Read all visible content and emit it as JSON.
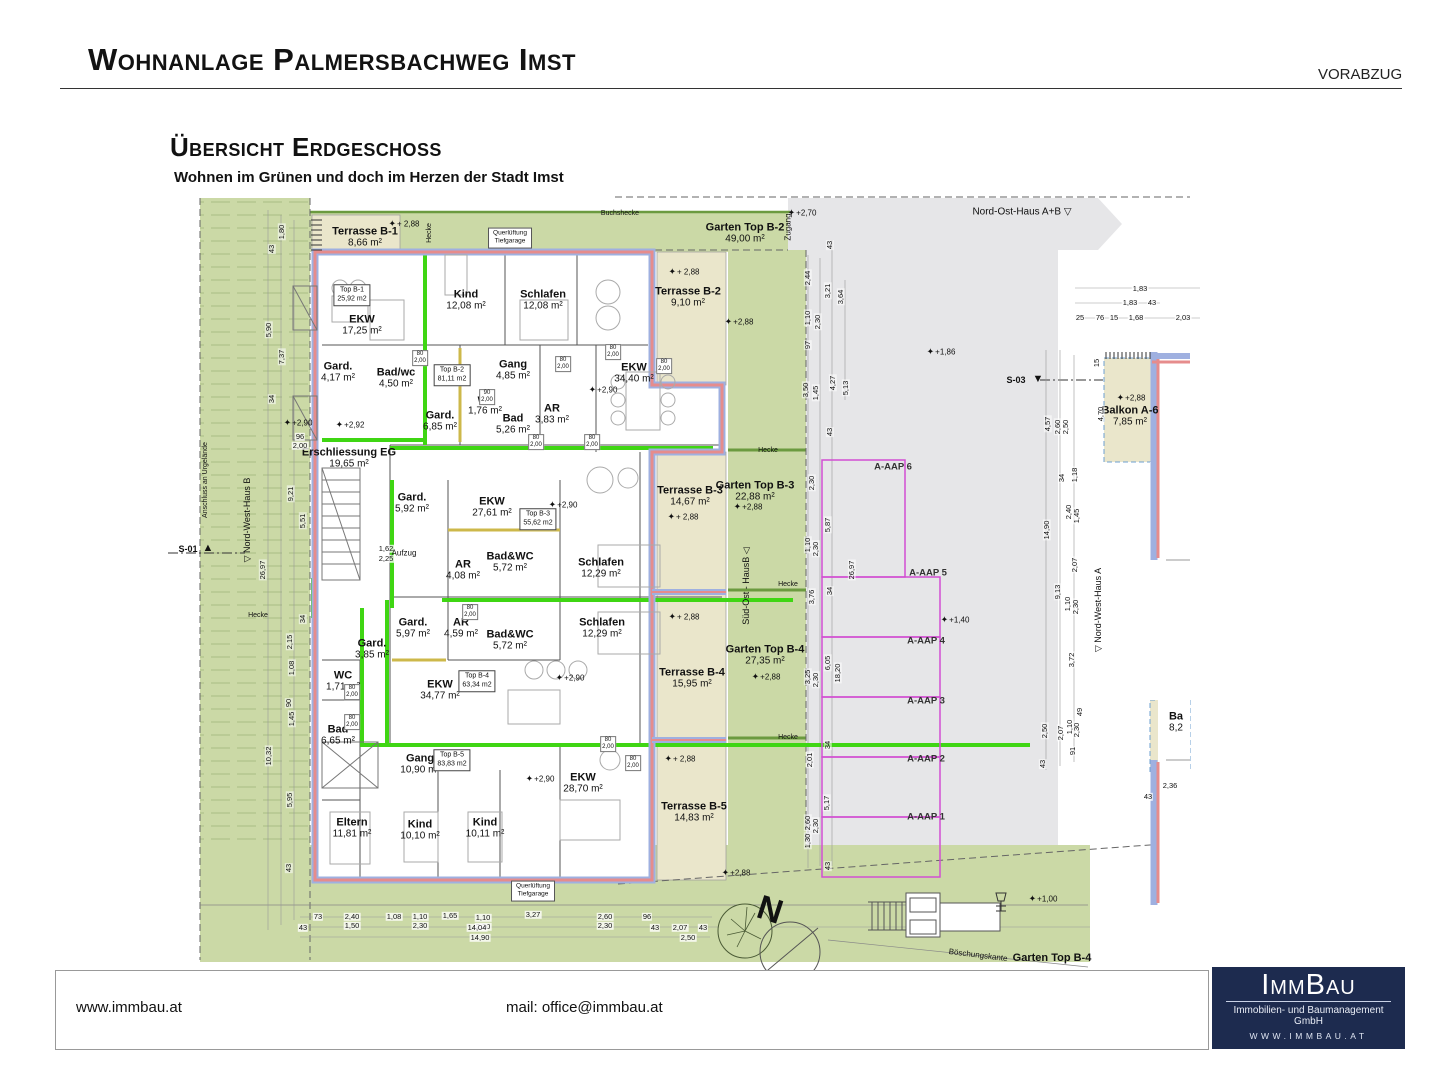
{
  "header": {
    "title": "Wohnanlage Palmersbachweg Imst",
    "stamp": "VORABZUG"
  },
  "section": {
    "title": "Übersicht Erdgeschoss",
    "subtitle": "Wohnen im Grünen und doch im Herzen der Stadt Imst"
  },
  "plan": {
    "rooms": [
      [
        "EKW",
        "17,25 m²",
        362,
        325
      ],
      [
        "Kind",
        "12,08 m²",
        466,
        300
      ],
      [
        "Schlafen",
        "12,08 m²",
        543,
        300
      ],
      [
        "EKW",
        "34,40 m²",
        634,
        373
      ],
      [
        "Gard.",
        "4,17 m²",
        338,
        372
      ],
      [
        "Bad/wc",
        "4,50 m²",
        396,
        378
      ],
      [
        "Gang",
        "4,85 m²",
        513,
        370
      ],
      [
        "wc",
        "1,76 m²",
        485,
        405
      ],
      [
        "Bad",
        "5,26 m²",
        513,
        424
      ],
      [
        "AR",
        "3,83 m²",
        552,
        414
      ],
      [
        "Gard.",
        "6,85 m²",
        440,
        421
      ],
      [
        "Erschliessung EG",
        "19,65 m²",
        349,
        458
      ],
      [
        "Gard.",
        "5,92 m²",
        412,
        503
      ],
      [
        "EKW",
        "27,61 m²",
        492,
        507
      ],
      [
        "AR",
        "4,08 m²",
        463,
        570
      ],
      [
        "Bad&WC",
        "5,72 m²",
        510,
        562
      ],
      [
        "Schlafen",
        "12,29 m²",
        601,
        568
      ],
      [
        "Gard.",
        "5,97 m²",
        413,
        628
      ],
      [
        "AR",
        "4,59 m²",
        461,
        628
      ],
      [
        "Bad&WC",
        "5,72 m²",
        510,
        640
      ],
      [
        "Schlafen",
        "12,29 m²",
        602,
        628
      ],
      [
        "Gard.",
        "3,85 m²",
        372,
        649
      ],
      [
        "WC",
        "1,71 m²",
        343,
        681
      ],
      [
        "EKW",
        "34,77 m²",
        440,
        690
      ],
      [
        "Bad",
        "6,65 m²",
        338,
        735
      ],
      [
        "Gang",
        "10,90 m²",
        420,
        764
      ],
      [
        "EKW",
        "28,70 m²",
        583,
        783
      ],
      [
        "Eltern",
        "11,81 m²",
        352,
        828
      ],
      [
        "Kind",
        "10,10 m²",
        420,
        830
      ],
      [
        "Kind",
        "10,11 m²",
        485,
        828
      ]
    ],
    "areas": [
      [
        "Terrasse B-1",
        "8,66 m²",
        365,
        237
      ],
      [
        "Garten Top B-2",
        "49,00 m²",
        745,
        233
      ],
      [
        "Terrasse B-2",
        "9,10 m²",
        688,
        297
      ],
      [
        "Terrasse B-3",
        "14,67 m²",
        690,
        496
      ],
      [
        "Garten Top B-3",
        "22,88 m²",
        755,
        491
      ],
      [
        "Garten Top B-4",
        "27,35 m²",
        765,
        655
      ],
      [
        "Terrasse B-4",
        "15,95 m²",
        692,
        678
      ],
      [
        "Terrasse B-5",
        "14,83 m²",
        694,
        812
      ],
      [
        "Balkon A-6",
        "7,85 m²",
        1130,
        416
      ],
      [
        "Ba",
        "8,2",
        1176,
        722
      ]
    ],
    "units": [
      [
        "Top B-1",
        "25,92 m2",
        352,
        295
      ],
      [
        "Top B-2",
        "81,11 m2",
        452,
        375
      ],
      [
        "Top B-3",
        "55,62 m2",
        538,
        519
      ],
      [
        "Top B-4",
        "63,34 m2",
        477,
        681
      ],
      [
        "Top B-5",
        "83,83 m2",
        452,
        760
      ]
    ],
    "aap": [
      [
        "A-AAP 6",
        893,
        468
      ],
      [
        "A-AAP 5",
        928,
        574
      ],
      [
        "A-AAP 4",
        926,
        642
      ],
      [
        "A-AAP 3",
        926,
        702
      ],
      [
        "A-AAP 2",
        926,
        760
      ],
      [
        "A-AAP 1",
        926,
        818
      ]
    ],
    "levels": [
      [
        "+ 2,88",
        404,
        224
      ],
      [
        "+2,70",
        802,
        213
      ],
      [
        "+ 2,88",
        684,
        272
      ],
      [
        "+2,88",
        739,
        322
      ],
      [
        "+1,86",
        941,
        352
      ],
      [
        "+2,88",
        1131,
        398
      ],
      [
        "+2,90",
        603,
        390
      ],
      [
        "+2,92",
        350,
        425
      ],
      [
        "+2,90",
        298,
        423
      ],
      [
        "+ 2,88",
        683,
        517
      ],
      [
        "+2,88",
        748,
        507
      ],
      [
        "+2,90",
        563,
        505
      ],
      [
        "+ 2,88",
        684,
        617
      ],
      [
        "+2,88",
        766,
        677
      ],
      [
        "+2,90",
        570,
        678
      ],
      [
        "+1,40",
        955,
        620
      ],
      [
        "+ 2,88",
        680,
        759
      ],
      [
        "+2,90",
        540,
        779
      ],
      [
        "+2,88",
        736,
        873
      ],
      [
        "+1,00",
        1043,
        899
      ]
    ],
    "dims": [
      [
        "1,80",
        282,
        232,
        1
      ],
      [
        "43",
        272,
        249,
        1
      ],
      [
        "5,90",
        269,
        330,
        1
      ],
      [
        "7,37",
        282,
        357,
        1
      ],
      [
        "34",
        272,
        399,
        1
      ],
      [
        "96",
        300,
        437,
        0
      ],
      [
        "2,00",
        300,
        446,
        0
      ],
      [
        "9,21",
        291,
        494,
        1
      ],
      [
        "5,51",
        303,
        521,
        1
      ],
      [
        "26,97",
        263,
        570,
        1
      ],
      [
        "34",
        303,
        619,
        1
      ],
      [
        "2,15",
        290,
        642,
        1
      ],
      [
        "1,08",
        292,
        668,
        1
      ],
      [
        "90",
        289,
        703,
        1
      ],
      [
        "1,45",
        292,
        719,
        1
      ],
      [
        "10,32",
        269,
        756,
        1
      ],
      [
        "5,95",
        290,
        800,
        1
      ],
      [
        "43",
        289,
        868,
        1
      ],
      [
        "2,44",
        808,
        278,
        1
      ],
      [
        "3,21",
        828,
        291,
        1
      ],
      [
        "3,64",
        841,
        297,
        1
      ],
      [
        "1,10",
        808,
        318,
        1
      ],
      [
        "2,30",
        818,
        322,
        1
      ],
      [
        "97",
        808,
        345,
        1
      ],
      [
        "43",
        830,
        245,
        1
      ],
      [
        "3,50",
        806,
        390,
        1
      ],
      [
        "1,45",
        816,
        393,
        1
      ],
      [
        "4,27",
        833,
        383,
        1
      ],
      [
        "5,13",
        846,
        388,
        1
      ],
      [
        "43",
        830,
        432,
        1
      ],
      [
        "2,30",
        812,
        483,
        1
      ],
      [
        "5,87",
        828,
        525,
        1
      ],
      [
        "26,97",
        852,
        570,
        1
      ],
      [
        "1,10",
        808,
        545,
        1
      ],
      [
        "2,30",
        816,
        549,
        1
      ],
      [
        "34",
        830,
        591,
        1
      ],
      [
        "3,76",
        812,
        597,
        1
      ],
      [
        "6,05",
        828,
        663,
        1
      ],
      [
        "18,20",
        838,
        673,
        1
      ],
      [
        "3,25",
        808,
        677,
        1
      ],
      [
        "2,30",
        816,
        680,
        1
      ],
      [
        "34",
        828,
        745,
        1
      ],
      [
        "2,01",
        810,
        760,
        1
      ],
      [
        "5,17",
        827,
        803,
        1
      ],
      [
        "2,60",
        808,
        823,
        1
      ],
      [
        "2,30",
        816,
        826,
        1
      ],
      [
        "1,30",
        808,
        841,
        1
      ],
      [
        "43",
        828,
        866,
        1
      ],
      [
        "1,83",
        1140,
        289,
        0
      ],
      [
        "1,83",
        1130,
        303,
        0
      ],
      [
        "43",
        1152,
        303,
        0
      ],
      [
        "25",
        1080,
        318,
        0
      ],
      [
        "76",
        1100,
        318,
        0
      ],
      [
        "15",
        1114,
        318,
        0
      ],
      [
        "1,68",
        1136,
        318,
        0
      ],
      [
        "2,03",
        1183,
        318,
        0
      ],
      [
        "15",
        1097,
        363,
        1
      ],
      [
        "4,57",
        1048,
        424,
        1
      ],
      [
        "2,60",
        1058,
        427,
        1
      ],
      [
        "2,50",
        1066,
        427,
        1
      ],
      [
        "4,70",
        1101,
        414,
        1
      ],
      [
        "34",
        1062,
        478,
        1
      ],
      [
        "1,18",
        1075,
        475,
        1
      ],
      [
        "2,40",
        1069,
        512,
        1
      ],
      [
        "1,45",
        1077,
        516,
        1
      ],
      [
        "14,90",
        1047,
        530,
        1
      ],
      [
        "2,07",
        1075,
        565,
        1
      ],
      [
        "9,13",
        1058,
        592,
        1
      ],
      [
        "1,10",
        1068,
        604,
        1
      ],
      [
        "2,30",
        1076,
        607,
        1
      ],
      [
        "3,72",
        1072,
        660,
        1
      ],
      [
        "49",
        1080,
        712,
        1
      ],
      [
        "2,50",
        1045,
        731,
        1
      ],
      [
        "2,07",
        1061,
        733,
        1
      ],
      [
        "1,10",
        1070,
        727,
        1
      ],
      [
        "2,30",
        1077,
        730,
        1
      ],
      [
        "91",
        1073,
        751,
        1
      ],
      [
        "43",
        1043,
        764,
        1
      ],
      [
        "2,36",
        1170,
        786,
        0
      ],
      [
        "43",
        1148,
        797,
        0
      ],
      [
        "73",
        318,
        917,
        0
      ],
      [
        "2,40",
        352,
        917,
        0
      ],
      [
        "1,50",
        352,
        926,
        0
      ],
      [
        "1,08",
        394,
        917,
        0
      ],
      [
        "1,10",
        420,
        917,
        0
      ],
      [
        "2,30",
        420,
        926,
        0
      ],
      [
        "1,65",
        450,
        916,
        0
      ],
      [
        "1,10",
        483,
        918,
        0
      ],
      [
        "2,30",
        483,
        927,
        0
      ],
      [
        "14,04",
        477,
        928,
        0
      ],
      [
        "14,90",
        480,
        938,
        0
      ],
      [
        "3,27",
        533,
        915,
        0
      ],
      [
        "2,60",
        605,
        917,
        0
      ],
      [
        "2,30",
        605,
        926,
        0
      ],
      [
        "96",
        647,
        917,
        0
      ],
      [
        "43",
        655,
        928,
        0
      ],
      [
        "2,07",
        680,
        928,
        0
      ],
      [
        "43",
        703,
        928,
        0
      ],
      [
        "2,50",
        688,
        938,
        0
      ],
      [
        "43",
        303,
        928,
        0
      ],
      [
        "1,62",
        386,
        549,
        0
      ],
      [
        "2,25",
        386,
        559,
        0
      ]
    ],
    "doortags": [
      [
        "80",
        "2,00",
        420,
        358
      ],
      [
        "80",
        "2,00",
        563,
        364
      ],
      [
        "80",
        "2,00",
        613,
        352
      ],
      [
        "80",
        "2,00",
        664,
        366
      ],
      [
        "90",
        "2,00",
        487,
        397
      ],
      [
        "80",
        "2,00",
        536,
        442
      ],
      [
        "80",
        "2,00",
        592,
        442
      ],
      [
        "80",
        "2,00",
        470,
        612
      ],
      [
        "80",
        "2,00",
        608,
        744
      ],
      [
        "80",
        "2,00",
        633,
        763
      ],
      [
        "80",
        "2,00",
        352,
        692
      ],
      [
        "80",
        "2,00",
        352,
        722
      ]
    ],
    "texts": [
      [
        "Buchshecke",
        620,
        214,
        {
          "s": 7
        }
      ],
      [
        "Hecke",
        430,
        233,
        {
          "v": 1,
          "s": 7
        }
      ],
      [
        "Querlüftung\nTiefgarage",
        510,
        238,
        {
          "box": 1,
          "s": 6.5,
          "nm": "vent-box-label"
        }
      ],
      [
        "Querlüftung\nTiefgarage",
        533,
        891,
        {
          "box": 1,
          "s": 6.5,
          "nm": "vent-box-label"
        }
      ],
      [
        "Nord-Ost-Haus A+B ▽",
        1022,
        212,
        {
          "s": 10,
          "nm": "building-ref-label"
        }
      ],
      [
        "Zugang",
        789,
        227,
        {
          "v": 1,
          "s": 8
        }
      ],
      [
        "Süd-Ost - HausB ◁",
        746,
        586,
        {
          "v": 1,
          "s": 9,
          "nm": "building-ref-label"
        }
      ],
      [
        "▽ Nord-West-Haus B",
        247,
        520,
        {
          "v": 1,
          "s": 9,
          "nm": "building-ref-label"
        }
      ],
      [
        "▽ Nord-West-Haus A",
        1098,
        610,
        {
          "v": 1,
          "s": 9,
          "nm": "building-ref-label"
        }
      ],
      [
        "Anschluss an Urgelände",
        206,
        480,
        {
          "v": 1,
          "s": 7
        }
      ],
      [
        "S-01",
        188,
        549,
        {
          "s": 9,
          "b": 1,
          "nm": "section-marker-label"
        }
      ],
      [
        "▲",
        208,
        548,
        {
          "s": 11,
          "nm": "section-marker-icon"
        }
      ],
      [
        "S-03",
        1016,
        380,
        {
          "s": 9,
          "b": 1,
          "nm": "section-marker-label"
        }
      ],
      [
        "▼",
        1038,
        379,
        {
          "s": 11,
          "nm": "section-marker-icon"
        }
      ],
      [
        "Hecke",
        768,
        451,
        {
          "s": 7
        }
      ],
      [
        "Hecke",
        788,
        585,
        {
          "s": 7
        }
      ],
      [
        "Hecke",
        788,
        738,
        {
          "s": 7
        }
      ],
      [
        "Hecke",
        258,
        616,
        {
          "s": 7
        }
      ],
      [
        "Aufzug",
        404,
        554,
        {
          "s": 8
        }
      ],
      [
        "Böschungskante",
        978,
        956,
        {
          "s": 8,
          "rot": 7
        }
      ],
      [
        "Garten Top B-4",
        1052,
        958,
        {
          "s": 11,
          "b": 1,
          "nm": "outdoor-area-label"
        }
      ],
      [
        "N",
        770,
        910,
        {
          "s": 34,
          "b": 1,
          "rot": 18,
          "nm": "north-arrow-label"
        }
      ]
    ]
  },
  "footer": {
    "website": "www.immbau.at",
    "email": "mail: office@immbau.at",
    "logo": {
      "name": "ImmBau",
      "subtitle": "Immobilien- und Baumanagement GmbH",
      "url": "WWW.IMMBAU.AT"
    }
  },
  "colors": {
    "garden_green": "#cbd9a6",
    "terrace_tan": "#eae6cb",
    "neighbor_grey": "#e6e6e8",
    "wall_blue": "#9fb0e0",
    "wall_red": "#e68c8c",
    "escape_green": "#3fd613",
    "parking_magenta": "#d24fd2",
    "logo_navy": "#1d2b4f"
  }
}
